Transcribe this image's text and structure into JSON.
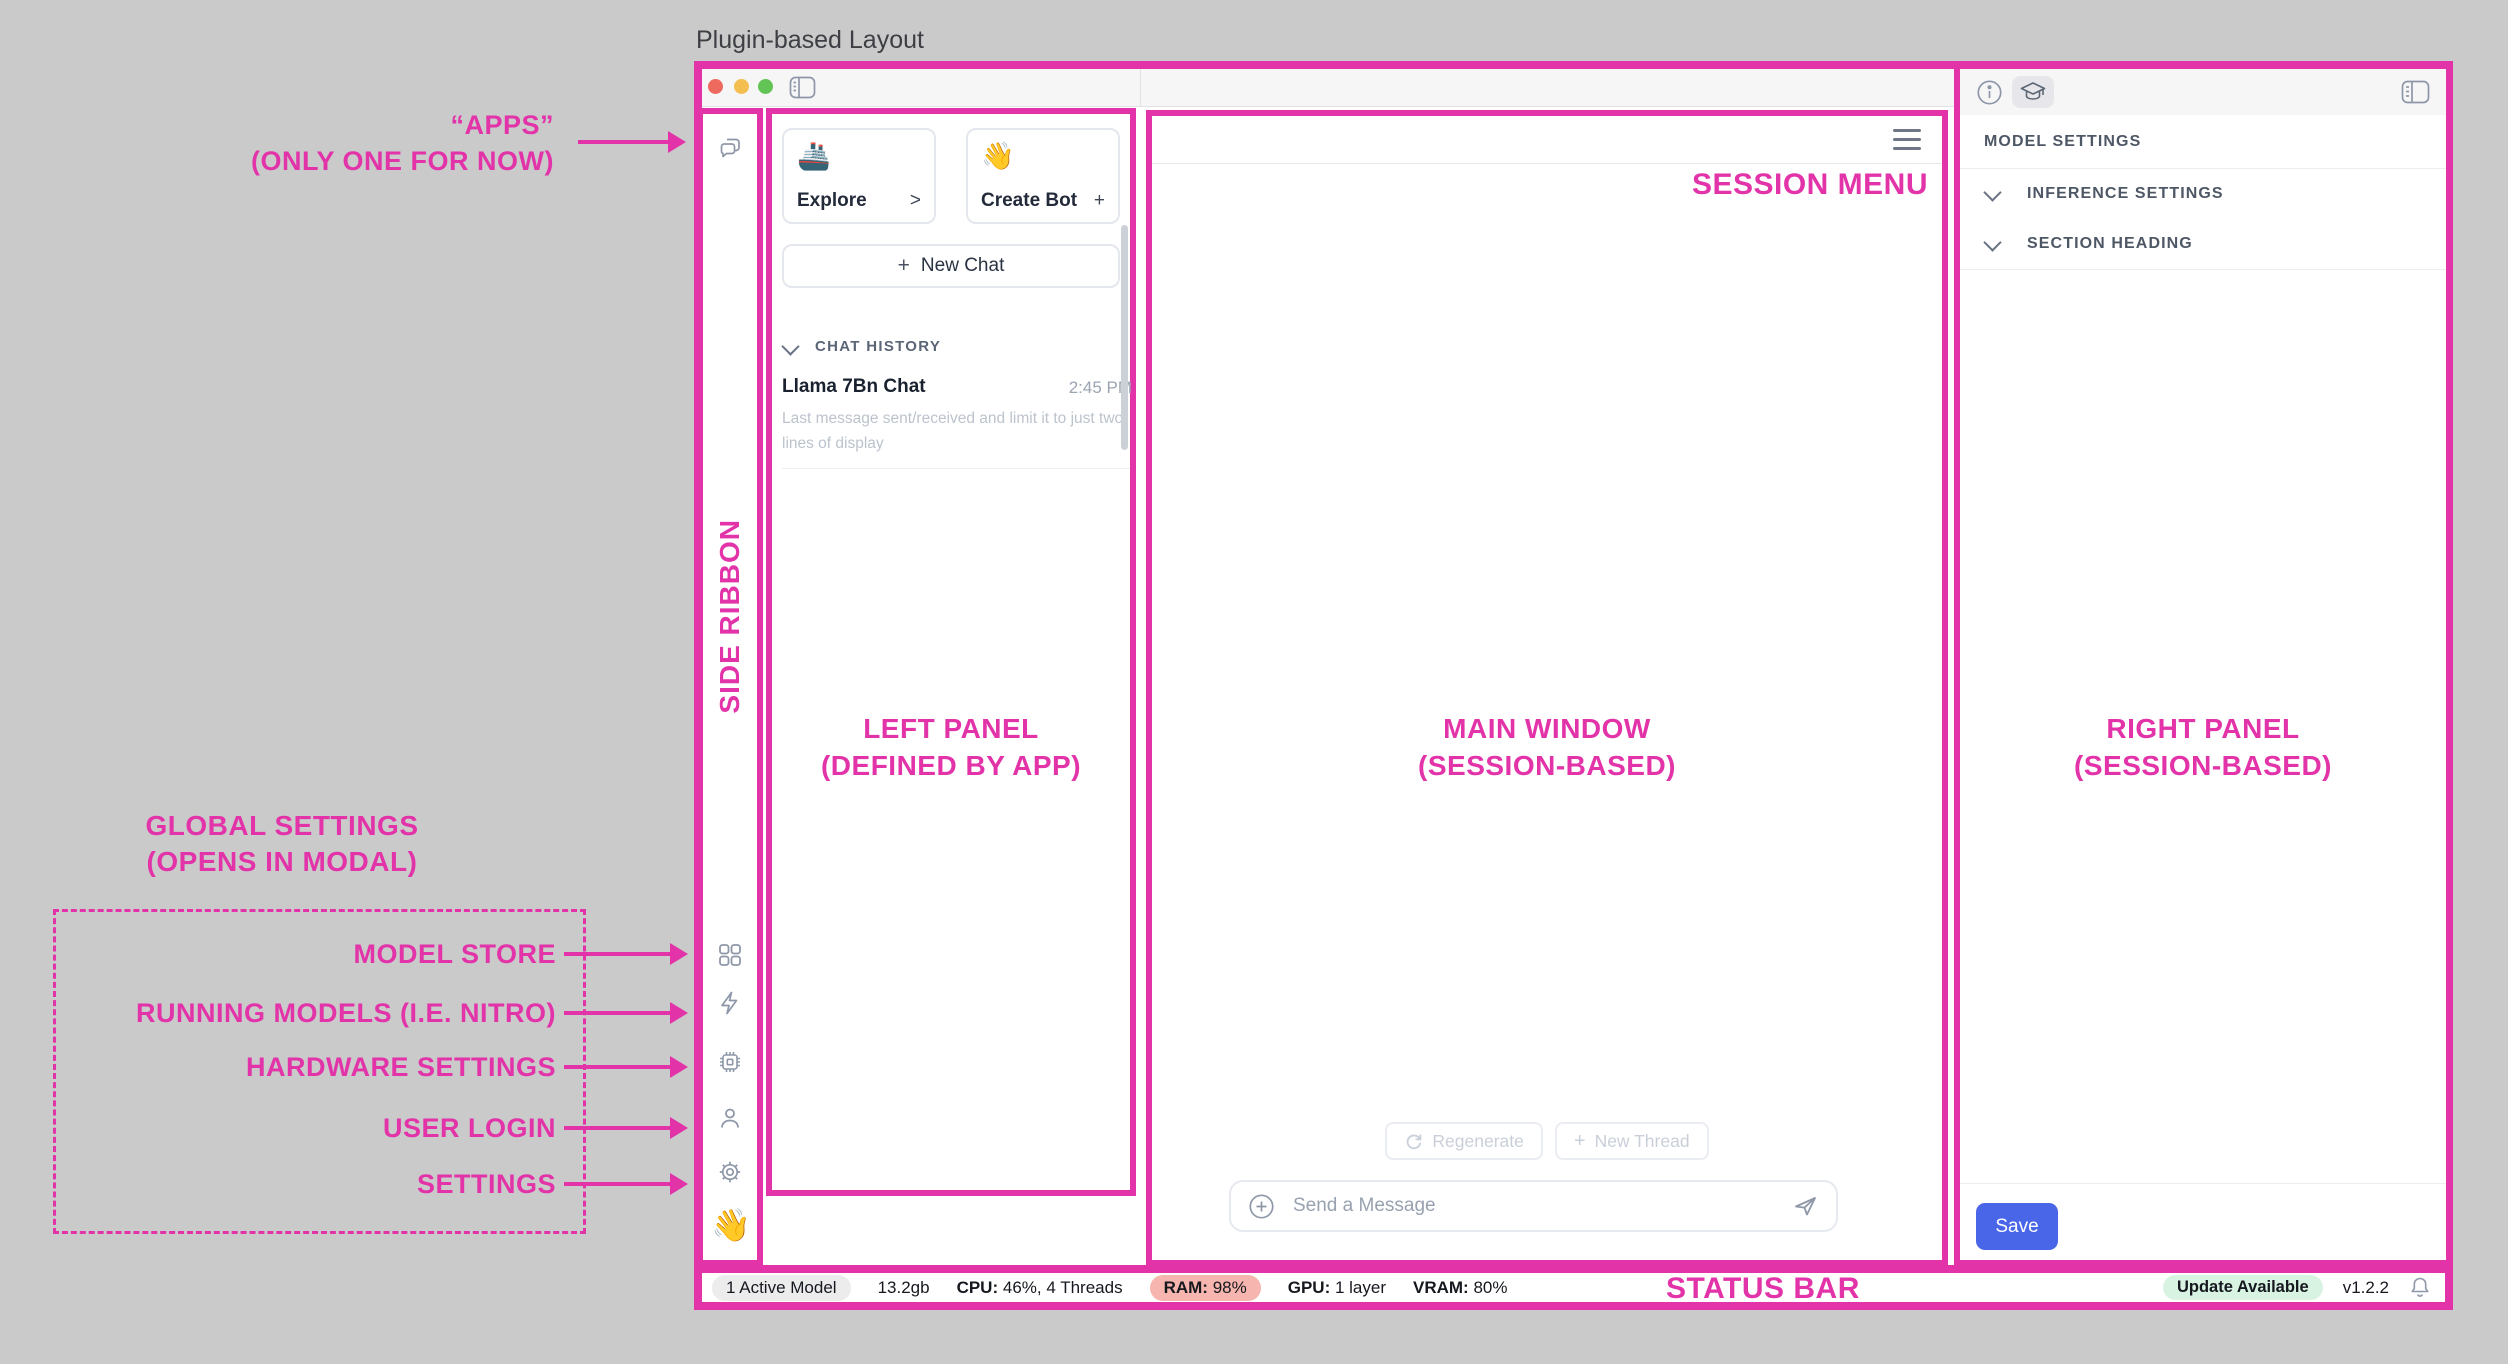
{
  "title": "Plugin-based Layout",
  "colors": {
    "annotation": "#E233A9",
    "save_button": "#4A66E8",
    "ram_badge_bg": "#F6B5AE",
    "update_badge_bg": "#D9F3E3",
    "active_model_badge_bg": "#ECECED"
  },
  "annotations": {
    "apps_label_line1": "“APPS”",
    "apps_label_line2": "(ONLY ONE FOR NOW)",
    "side_ribbon": "SIDE RIBBON",
    "left_panel_line1": "LEFT PANEL",
    "left_panel_line2": "(DEFINED BY APP)",
    "main_window_line1": "MAIN WINDOW",
    "main_window_line2": "(SESSION-BASED)",
    "right_panel_line1": "RIGHT PANEL",
    "right_panel_line2": "(SESSION-BASED)",
    "session_menu": "SESSION MENU",
    "status_bar": "STATUS BAR",
    "global_settings_line1": "GLOBAL SETTINGS",
    "global_settings_line2": "(OPENS IN MODAL)",
    "global_items": [
      "MODEL STORE",
      "RUNNING MODELS (I.E. NITRO)",
      "HARDWARE SETTINGS",
      "USER LOGIN",
      "SETTINGS"
    ]
  },
  "left_panel": {
    "explore_card": {
      "emoji": "🚢",
      "label": "Explore",
      "affordance": ">"
    },
    "create_bot_card": {
      "emoji": "👋",
      "label": "Create Bot",
      "affordance": "+"
    },
    "new_chat_plus": "+",
    "new_chat_label": "New Chat",
    "history_header": "CHAT HISTORY",
    "chat_item": {
      "title": "Llama 7Bn Chat",
      "time": "2:45 PM",
      "preview": "Last message sent/received and limit it to just two lines of display"
    }
  },
  "main_window": {
    "regenerate_label": "Regenerate",
    "new_thread_plus": "+",
    "new_thread_label": "New Thread",
    "composer_placeholder": "Send a Message"
  },
  "right_panel": {
    "section_title": "MODEL SETTINGS",
    "sections": [
      "INFERENCE SETTINGS",
      "SECTION HEADING"
    ],
    "save_label": "Save"
  },
  "ribbon": {
    "app_emoji": "👋"
  },
  "status_bar": {
    "active_model": "1 Active Model",
    "memory": "13.2gb",
    "cpu_label": "CPU:",
    "cpu_value": "46%, 4 Threads",
    "ram_label": "RAM:",
    "ram_value": "98%",
    "gpu_label": "GPU:",
    "gpu_value": "1 layer",
    "vram_label": "VRAM:",
    "vram_value": "80%",
    "update_badge": "Update Available",
    "version": "v1.2.2"
  }
}
